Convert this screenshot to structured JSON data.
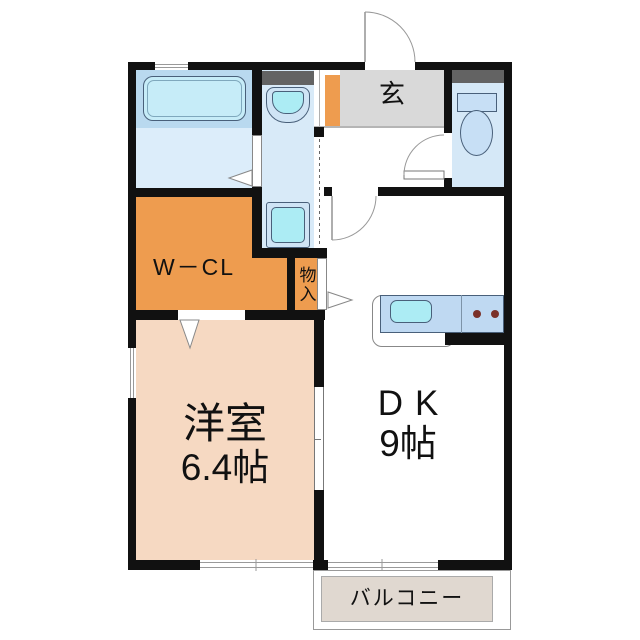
{
  "plan": {
    "title": "1DK floor plan",
    "rooms": {
      "entrance": {
        "label": "玄"
      },
      "walk_in_closet": {
        "label": "W－CL"
      },
      "storage": {
        "label": "物入"
      },
      "western_room": {
        "label": "洋室",
        "size": "6.4帖"
      },
      "dining_kitchen": {
        "label": "DK",
        "size": "9帖"
      },
      "balcony": {
        "label": "バルコニー"
      }
    },
    "colors": {
      "wall": "#111111",
      "orange": "#EE9C4F",
      "pink": "#F6D9C2",
      "genkan_gray": "#D9D9D9",
      "shelf_gray": "#636363",
      "bath_surround": "#B9D9EF",
      "tub_fill": "#C6ECF8",
      "bath_floor": "#DCEDFA",
      "wash_floor": "#D8EAF8",
      "fixture_cyan": "#ACECF4",
      "fixture_pale": "#CFE4F5",
      "toilet_floor": "#D5E8F7",
      "toilet_fixture": "#C7DFF5",
      "counter_blue": "#BFD9F2",
      "burner_brown": "#7A3028",
      "balcony_beige": "#E0D8D0",
      "line": "#777777"
    }
  }
}
